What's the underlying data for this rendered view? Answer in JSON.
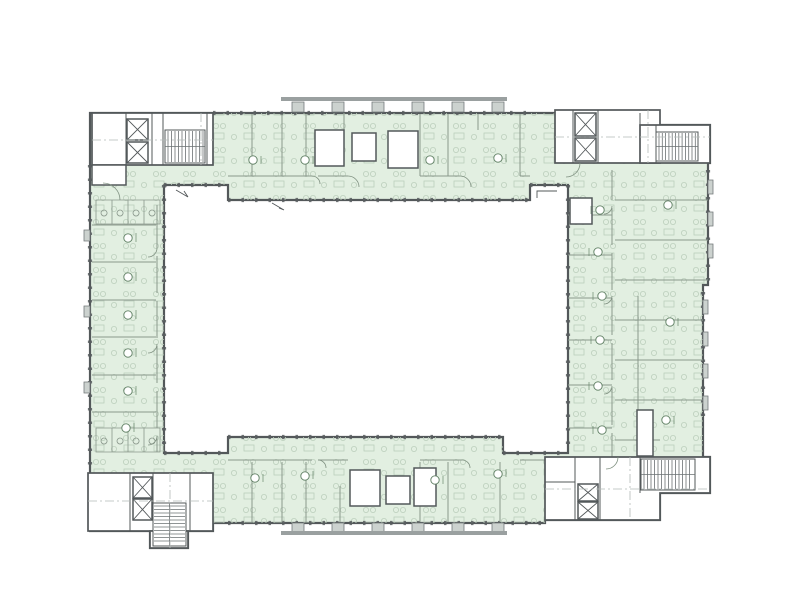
{
  "colors": {
    "background": "#ffffff",
    "room_fill": "#e2efe1",
    "wall": "#53585a",
    "partition": "#8a988c",
    "furniture": "#bccfbc",
    "stair": "#6b7173",
    "column_fill": "#ccd2cf",
    "column_stroke": "#73797a",
    "roof_bar": "#9aa0a0",
    "marker": "#5f7f63",
    "door": "#7f9080",
    "dashdot": "#b4bab8",
    "tick": "#585d5f"
  }
}
